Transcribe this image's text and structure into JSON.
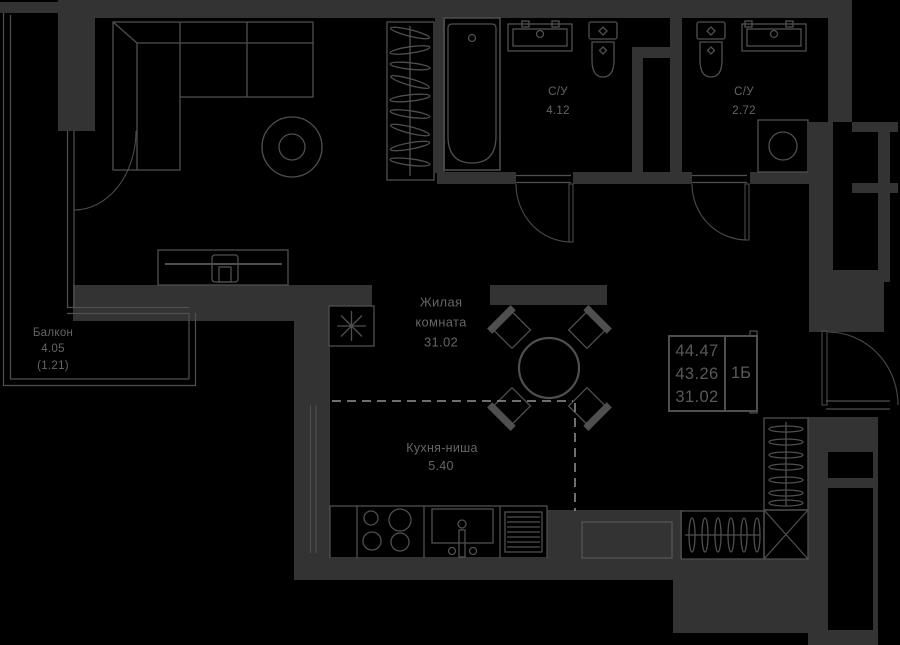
{
  "plan_title": "1-room apartment floor plan",
  "rooms": {
    "living": {
      "line1": "Жилая",
      "line2": "комната",
      "area": "31.02"
    },
    "kitchen": {
      "name": "Кухня-ниша",
      "area": "5.40"
    },
    "bath1": {
      "name": "С/У",
      "area": "4.12"
    },
    "bath2": {
      "name": "С/У",
      "area": "2.72"
    },
    "balcony": {
      "name": "Балкон",
      "area": "4.05",
      "area_coeff": "(1.21)"
    }
  },
  "info_box": {
    "total_area": "44.47",
    "reduced_area": "43.26",
    "living_area": "31.02",
    "flat_type": "1Б"
  },
  "colors": {
    "background": "#000000",
    "wall_fill": "#333333",
    "furniture_line": "#4f4f4f",
    "text": "#656565",
    "dashed_line": "#949494"
  }
}
